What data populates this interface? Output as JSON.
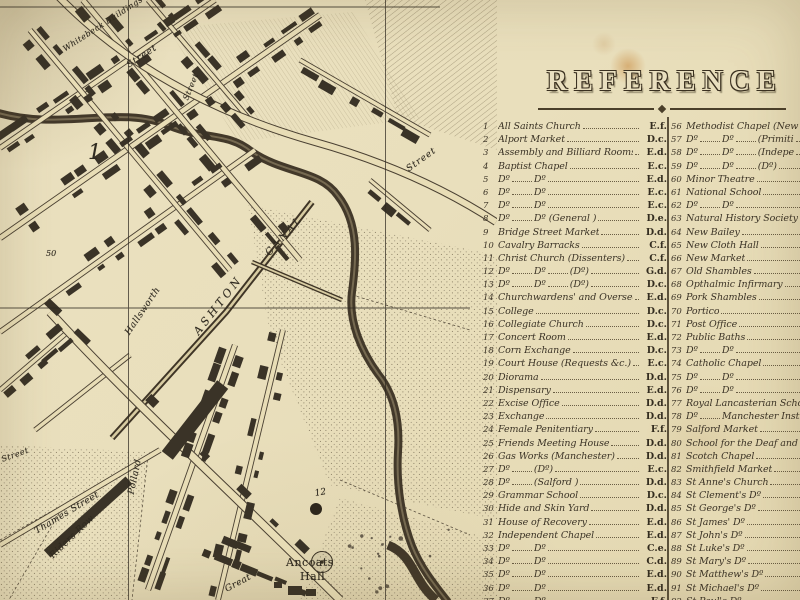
{
  "colors": {
    "parchment": "#e9dfbc",
    "ink": "#3b3326",
    "stain": "#c08030",
    "building": "#3a3327"
  },
  "map": {
    "labels": [
      {
        "t": "1",
        "x": 88,
        "y": 142,
        "s": 21,
        "r": 0,
        "ls": 0
      },
      {
        "t": "50",
        "x": 46,
        "y": 250,
        "s": 8,
        "r": 0,
        "ls": 0
      },
      {
        "t": "12",
        "x": 315,
        "y": 490,
        "s": 9,
        "r": -10,
        "ls": 0
      },
      {
        "t": "Ancoats",
        "x": 286,
        "y": 557,
        "s": 11,
        "r": 0,
        "ls": 0.5,
        "up": true
      },
      {
        "t": "Hall",
        "x": 300,
        "y": 571,
        "s": 11,
        "r": 0,
        "ls": 0.5,
        "up": true
      },
      {
        "t": "ASHTON",
        "x": 196,
        "y": 328,
        "s": 11,
        "r": -52,
        "ls": 3.5
      },
      {
        "t": "CANAL",
        "x": 268,
        "y": 250,
        "s": 10,
        "r": -48,
        "ls": 2.5
      },
      {
        "t": "Whitebeck Buildings",
        "x": 64,
        "y": 46,
        "s": 8,
        "r": -33,
        "ls": 0.5
      },
      {
        "t": "Street",
        "x": 128,
        "y": 62,
        "s": 9,
        "r": -33,
        "ls": 1
      },
      {
        "t": "Street",
        "x": 186,
        "y": 96,
        "s": 8,
        "r": -68,
        "ls": 0.5
      },
      {
        "t": "Street",
        "x": 408,
        "y": 166,
        "s": 9,
        "r": -36,
        "ls": 1
      },
      {
        "t": "Hallsworth",
        "x": 128,
        "y": 330,
        "s": 9,
        "r": -56,
        "ls": 0.5
      },
      {
        "t": "Pollard",
        "x": 132,
        "y": 490,
        "s": 9,
        "r": -78,
        "ls": 0.5
      },
      {
        "t": "Thames Street",
        "x": 36,
        "y": 528,
        "s": 9,
        "r": -31,
        "ls": 0.5
      },
      {
        "t": "Riders Row",
        "x": 52,
        "y": 553,
        "s": 9,
        "r": -44,
        "ls": 0.5
      },
      {
        "t": "Great",
        "x": 226,
        "y": 586,
        "s": 9,
        "r": -28,
        "ls": 0.5
      },
      {
        "t": "Street",
        "x": 2,
        "y": 456,
        "s": 8,
        "r": -20,
        "ls": 0.5
      }
    ]
  },
  "legend": {
    "title": "REFERENCE",
    "columns": [
      {
        "items": [
          {
            "n": "1",
            "parts": [
              "All Saints Church"
            ],
            "ref": "E.f."
          },
          {
            "n": "2",
            "parts": [
              "Alport Market"
            ],
            "ref": "D.c."
          },
          {
            "n": "3",
            "parts": [
              "Assembly and Billiard Rooms"
            ],
            "ref": "E.d."
          },
          {
            "n": "4",
            "parts": [
              "Baptist Chapel"
            ],
            "ref": "E.c."
          },
          {
            "n": "5",
            "parts": [
              "Dº",
              "Dº"
            ],
            "ref": "E.d."
          },
          {
            "n": "6",
            "parts": [
              "Dº",
              "Dº"
            ],
            "ref": "E.c."
          },
          {
            "n": "7",
            "parts": [
              "Dº",
              "Dº"
            ],
            "ref": "E.c."
          },
          {
            "n": "8",
            "parts": [
              "Dº",
              "Dº (General )"
            ],
            "ref": "D.e."
          },
          {
            "n": "9",
            "parts": [
              "Bridge Street Market"
            ],
            "ref": "D.d."
          },
          {
            "n": "10",
            "parts": [
              "Cavalry Barracks"
            ],
            "ref": "C.f."
          },
          {
            "n": "11",
            "parts": [
              "Christ Church (Dissenters)"
            ],
            "ref": "C.f."
          },
          {
            "n": "12",
            "parts": [
              "Dº",
              "Dº",
              "(Dº)"
            ],
            "ref": "G.d."
          },
          {
            "n": "13",
            "parts": [
              "Dº",
              "Dº",
              "(Dº)"
            ],
            "ref": "D.c."
          },
          {
            "n": "14",
            "parts": [
              "Churchwardens' and Overseers' Office"
            ],
            "ref": "E.d."
          },
          {
            "n": "15",
            "parts": [
              "College"
            ],
            "ref": "D.c."
          },
          {
            "n": "16",
            "parts": [
              "Collegiate Church"
            ],
            "ref": "D.c."
          },
          {
            "n": "17",
            "parts": [
              "Concert Room"
            ],
            "ref": "E.d."
          },
          {
            "n": "18",
            "parts": [
              "Corn Exchange"
            ],
            "ref": "D.c."
          },
          {
            "n": "19",
            "parts": [
              "Court House (Requests &c.)"
            ],
            "ref": "E.c."
          },
          {
            "n": "20",
            "parts": [
              "Diorama"
            ],
            "ref": "D.d."
          },
          {
            "n": "21",
            "parts": [
              "Dispensary"
            ],
            "ref": "E.d."
          },
          {
            "n": "22",
            "parts": [
              "Excise Office"
            ],
            "ref": "D.d."
          },
          {
            "n": "23",
            "parts": [
              "Exchange"
            ],
            "ref": "D.d."
          },
          {
            "n": "24",
            "parts": [
              "Female Penitentiary"
            ],
            "ref": "F.f."
          },
          {
            "n": "25",
            "parts": [
              "Friends Meeting House"
            ],
            "ref": "D.d."
          },
          {
            "n": "26",
            "parts": [
              "Gas Works (Manchester)"
            ],
            "ref": "D.d."
          },
          {
            "n": "27",
            "parts": [
              "Dº",
              "(Dº)"
            ],
            "ref": "E.c."
          },
          {
            "n": "28",
            "parts": [
              "Dº",
              "(Salford )"
            ],
            "ref": "D.d."
          },
          {
            "n": "29",
            "parts": [
              "Grammar School"
            ],
            "ref": "D.c."
          },
          {
            "n": "30",
            "parts": [
              "Hide and Skin Yard"
            ],
            "ref": "D.d."
          },
          {
            "n": "31",
            "parts": [
              "House of Recovery"
            ],
            "ref": "E.d."
          },
          {
            "n": "32",
            "parts": [
              "Independent Chapel"
            ],
            "ref": "E.d."
          },
          {
            "n": "33",
            "parts": [
              "Dº",
              "Dº"
            ],
            "ref": "C.e."
          },
          {
            "n": "34",
            "parts": [
              "Dº",
              "Dº"
            ],
            "ref": "C.d."
          },
          {
            "n": "35",
            "parts": [
              "Dº",
              "Dº"
            ],
            "ref": "E.d."
          },
          {
            "n": "36",
            "parts": [
              "Dº",
              "Dº"
            ],
            "ref": "E.d."
          },
          {
            "n": "37",
            "parts": [
              "Dº",
              "Dº"
            ],
            "ref": "F.f."
          }
        ]
      },
      {
        "items": [
          {
            "n": "56",
            "parts": [
              "Methodist Chapel (New Co"
            ],
            "ref": ""
          },
          {
            "n": "57",
            "parts": [
              "Dº",
              "Dº",
              "(Primiti"
            ],
            "ref": ""
          },
          {
            "n": "58",
            "parts": [
              "Dº",
              "Dº",
              "(Indepe"
            ],
            "ref": ""
          },
          {
            "n": "59",
            "parts": [
              "Dº",
              "Dº",
              "(Dº)"
            ],
            "ref": ""
          },
          {
            "n": "60",
            "parts": [
              "Minor Theatre"
            ],
            "ref": ""
          },
          {
            "n": "61",
            "parts": [
              "National School"
            ],
            "ref": ""
          },
          {
            "n": "62",
            "parts": [
              "Dº",
              "Dº"
            ],
            "ref": ""
          },
          {
            "n": "63",
            "parts": [
              "Natural History Society"
            ],
            "ref": ""
          },
          {
            "n": "64",
            "parts": [
              "New Bailey"
            ],
            "ref": ""
          },
          {
            "n": "65",
            "parts": [
              "New Cloth Hall"
            ],
            "ref": ""
          },
          {
            "n": "66",
            "parts": [
              "New Market"
            ],
            "ref": ""
          },
          {
            "n": "67",
            "parts": [
              "Old Shambles"
            ],
            "ref": ""
          },
          {
            "n": "68",
            "parts": [
              "Opthalmic Infirmary"
            ],
            "ref": ""
          },
          {
            "n": "69",
            "parts": [
              "Pork Shambles"
            ],
            "ref": ""
          },
          {
            "n": "70",
            "parts": [
              "Portico"
            ],
            "ref": ""
          },
          {
            "n": "71",
            "parts": [
              "Post Office"
            ],
            "ref": ""
          },
          {
            "n": "72",
            "parts": [
              "Public Baths"
            ],
            "ref": ""
          },
          {
            "n": "73",
            "parts": [
              "Dº",
              "Dº"
            ],
            "ref": ""
          },
          {
            "n": "74",
            "parts": [
              "Catholic Chapel"
            ],
            "ref": ""
          },
          {
            "n": "75",
            "parts": [
              "Dº",
              "Dº"
            ],
            "ref": ""
          },
          {
            "n": "76",
            "parts": [
              "Dº",
              "Dº"
            ],
            "ref": ""
          },
          {
            "n": "77",
            "parts": [
              "Royal Lancasterian  Scho"
            ],
            "ref": ""
          },
          {
            "n": "78",
            "parts": [
              "Dº",
              "Manchester Institu"
            ],
            "ref": ""
          },
          {
            "n": "79",
            "parts": [
              "Salford Market"
            ],
            "ref": ""
          },
          {
            "n": "80",
            "parts": [
              "School for the Deaf and D"
            ],
            "ref": ""
          },
          {
            "n": "81",
            "parts": [
              "Scotch Chapel"
            ],
            "ref": ""
          },
          {
            "n": "82",
            "parts": [
              "Smithfield Market"
            ],
            "ref": ""
          },
          {
            "n": "83",
            "parts": [
              "St Anne's Church"
            ],
            "ref": ""
          },
          {
            "n": "84",
            "parts": [
              "St Clement's Dº"
            ],
            "ref": ""
          },
          {
            "n": "85",
            "parts": [
              "St George's Dº"
            ],
            "ref": ""
          },
          {
            "n": "86",
            "parts": [
              "St James' Dº"
            ],
            "ref": ""
          },
          {
            "n": "87",
            "parts": [
              "St John's Dº"
            ],
            "ref": ""
          },
          {
            "n": "88",
            "parts": [
              "St Luke's Dº"
            ],
            "ref": ""
          },
          {
            "n": "89",
            "parts": [
              "St Mary's Dº"
            ],
            "ref": ""
          },
          {
            "n": "90",
            "parts": [
              "St Matthew's Dº"
            ],
            "ref": ""
          },
          {
            "n": "91",
            "parts": [
              "St Michael's Dº"
            ],
            "ref": ""
          },
          {
            "n": "92",
            "parts": [
              "St Paul's Dº"
            ],
            "ref": ""
          }
        ]
      }
    ]
  }
}
